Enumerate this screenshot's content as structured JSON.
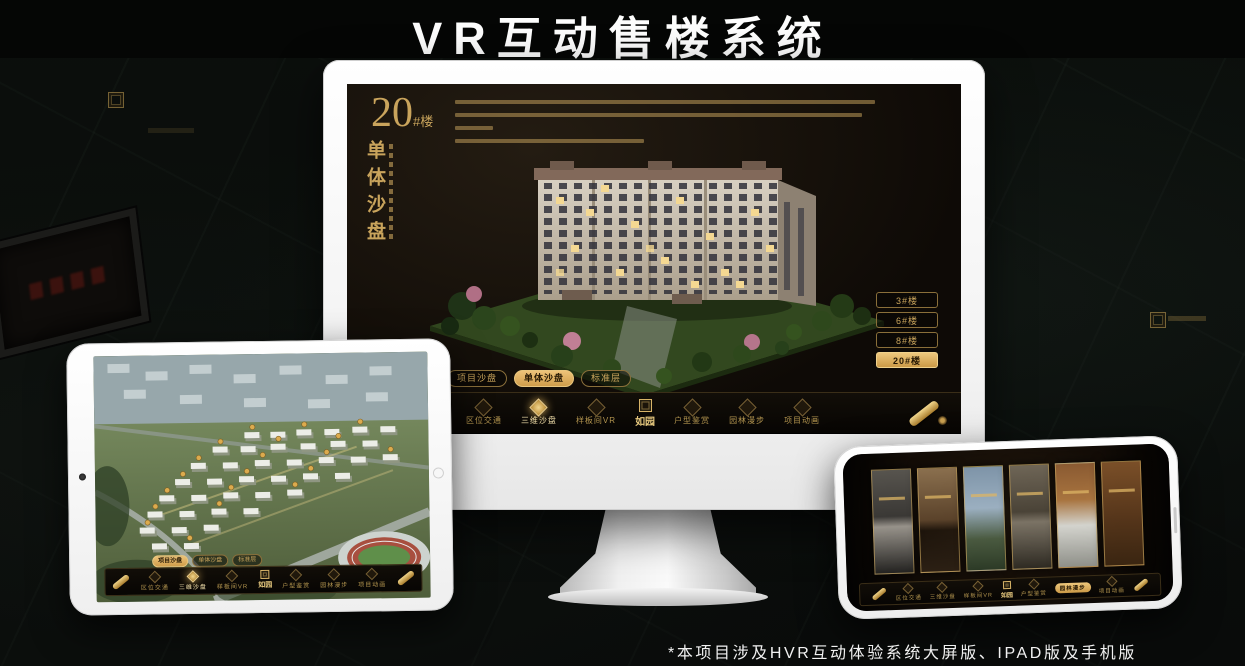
{
  "page": {
    "title": "VR互动售楼系统",
    "footnote": "*本项目涉及HVR互动体验系统大屏版、IPAD版及手机版"
  },
  "app": {
    "logo": "如园",
    "nav_items": [
      "区位交通",
      "三维沙盘",
      "样板间VR",
      "户型鉴赏",
      "园林漫步",
      "项目动画"
    ],
    "view_tabs": [
      "项目沙盘",
      "单体沙盘",
      "标准层"
    ],
    "colors": {
      "gold": "#c9a45c",
      "gold_bright": "#e3bc72",
      "screen_bg": "#14100a"
    }
  },
  "monitor": {
    "floor_title": {
      "number": "20",
      "unit": "#楼",
      "subtitle": "单体沙盘"
    },
    "floor_buttons": [
      {
        "label": "3#楼",
        "active": false
      },
      {
        "label": "6#楼",
        "active": false
      },
      {
        "label": "8#楼",
        "active": false
      },
      {
        "label": "20#楼",
        "active": true
      }
    ],
    "active_tab": "单体沙盘",
    "active_nav": "三维沙盘"
  },
  "tablet": {
    "active_tab": "项目沙盘",
    "active_nav": "三维沙盘"
  },
  "phone": {
    "active_nav": "园林漫步"
  }
}
